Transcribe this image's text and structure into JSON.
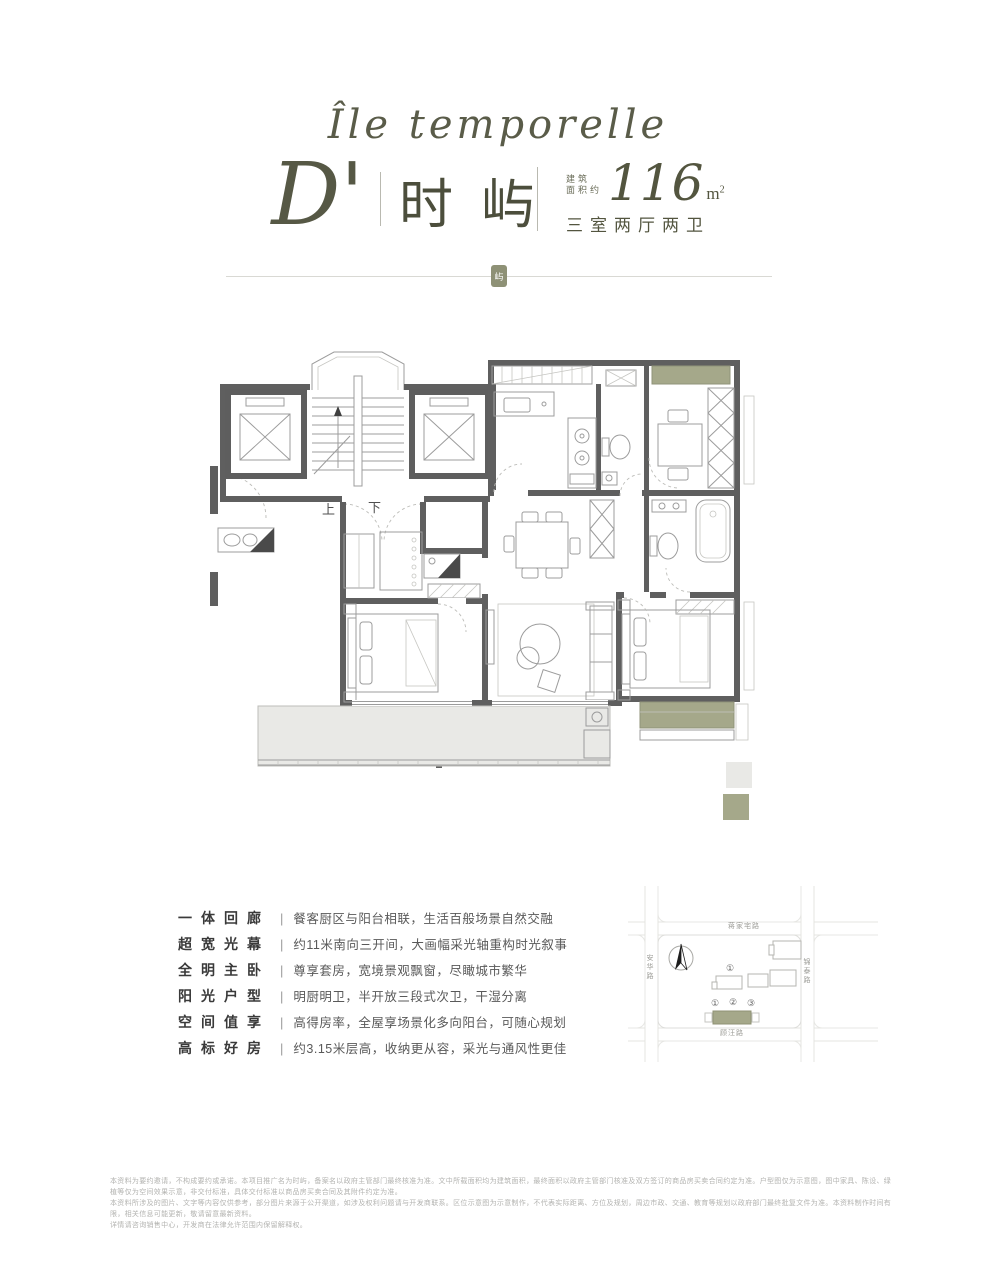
{
  "header": {
    "script_title": "Île temporelle",
    "unit_letter": "D'",
    "unit_name": "时屿",
    "area_label_line1": "建筑",
    "area_label_line2": "面积约",
    "area_value": "116",
    "area_unit_base": "m",
    "area_unit_sup": "2",
    "layout_text": "三室两厅两卫"
  },
  "emblem": {
    "glyph": "屿"
  },
  "floorplan": {
    "stair_up": "上",
    "stair_down": "下",
    "legend": {
      "balcony_color": "#e9e9e6",
      "bay_window_color": "#a5a88a"
    }
  },
  "features": {
    "separator": "|",
    "items": [
      {
        "title": "一体回廊",
        "desc": "餐客厨区与阳台相联，生活百般场景自然交融"
      },
      {
        "title": "超宽光幕",
        "desc": "约11米南向三开间，大画幅采光轴重构时光叙事"
      },
      {
        "title": "全明主卧",
        "desc": "尊享套房，宽境景观飘窗，尽瞰城市繁华"
      },
      {
        "title": "阳光户型",
        "desc": "明厨明卫，半开放三段式次卫，干湿分离"
      },
      {
        "title": "空间值享",
        "desc": "高得房率，全屋享场景化多向阳台，可随心规划"
      },
      {
        "title": "高标好房",
        "desc": "约3.15米层高，收纳更从容，采光与通风性更佳"
      }
    ]
  },
  "map": {
    "roads": {
      "top": "蒋家宅路",
      "left": "安华路",
      "right": "锦泰路",
      "bottom": "顾汪路"
    },
    "site_numbers": {
      "mid": "①",
      "b1": "①",
      "b2": "②",
      "b3": "③"
    }
  },
  "disclaimer": {
    "line1": "本资料为要约邀请，不构成要约或承诺。本项目推广名为时屿，备案名以政府主管部门最终核准为准。文中所载面积均为建筑面积，最终面积以政府主管部门核准及双方签订的商品房买卖合同约定为准。户型图仅为示意图，图中家具、陈设、绿植等仅为空间效果示意，非交付标准，具体交付标准以商品房买卖合同及其附件约定为准。",
    "line2": "本资料所涉及的图片、文字等内容仅供参考，部分图片来源于公开渠道，如涉及权利问题请与开发商联系。区位示意图为示意制作，不代表实际距离、方位及规划，周边市政、交通、教育等规划以政府部门最终批复文件为准。本资料制作时间有限，相关信息可能更新，敬请留意最新资料。",
    "line3": "详情请咨询销售中心，开发商在法律允许范围内保留解释权。"
  }
}
